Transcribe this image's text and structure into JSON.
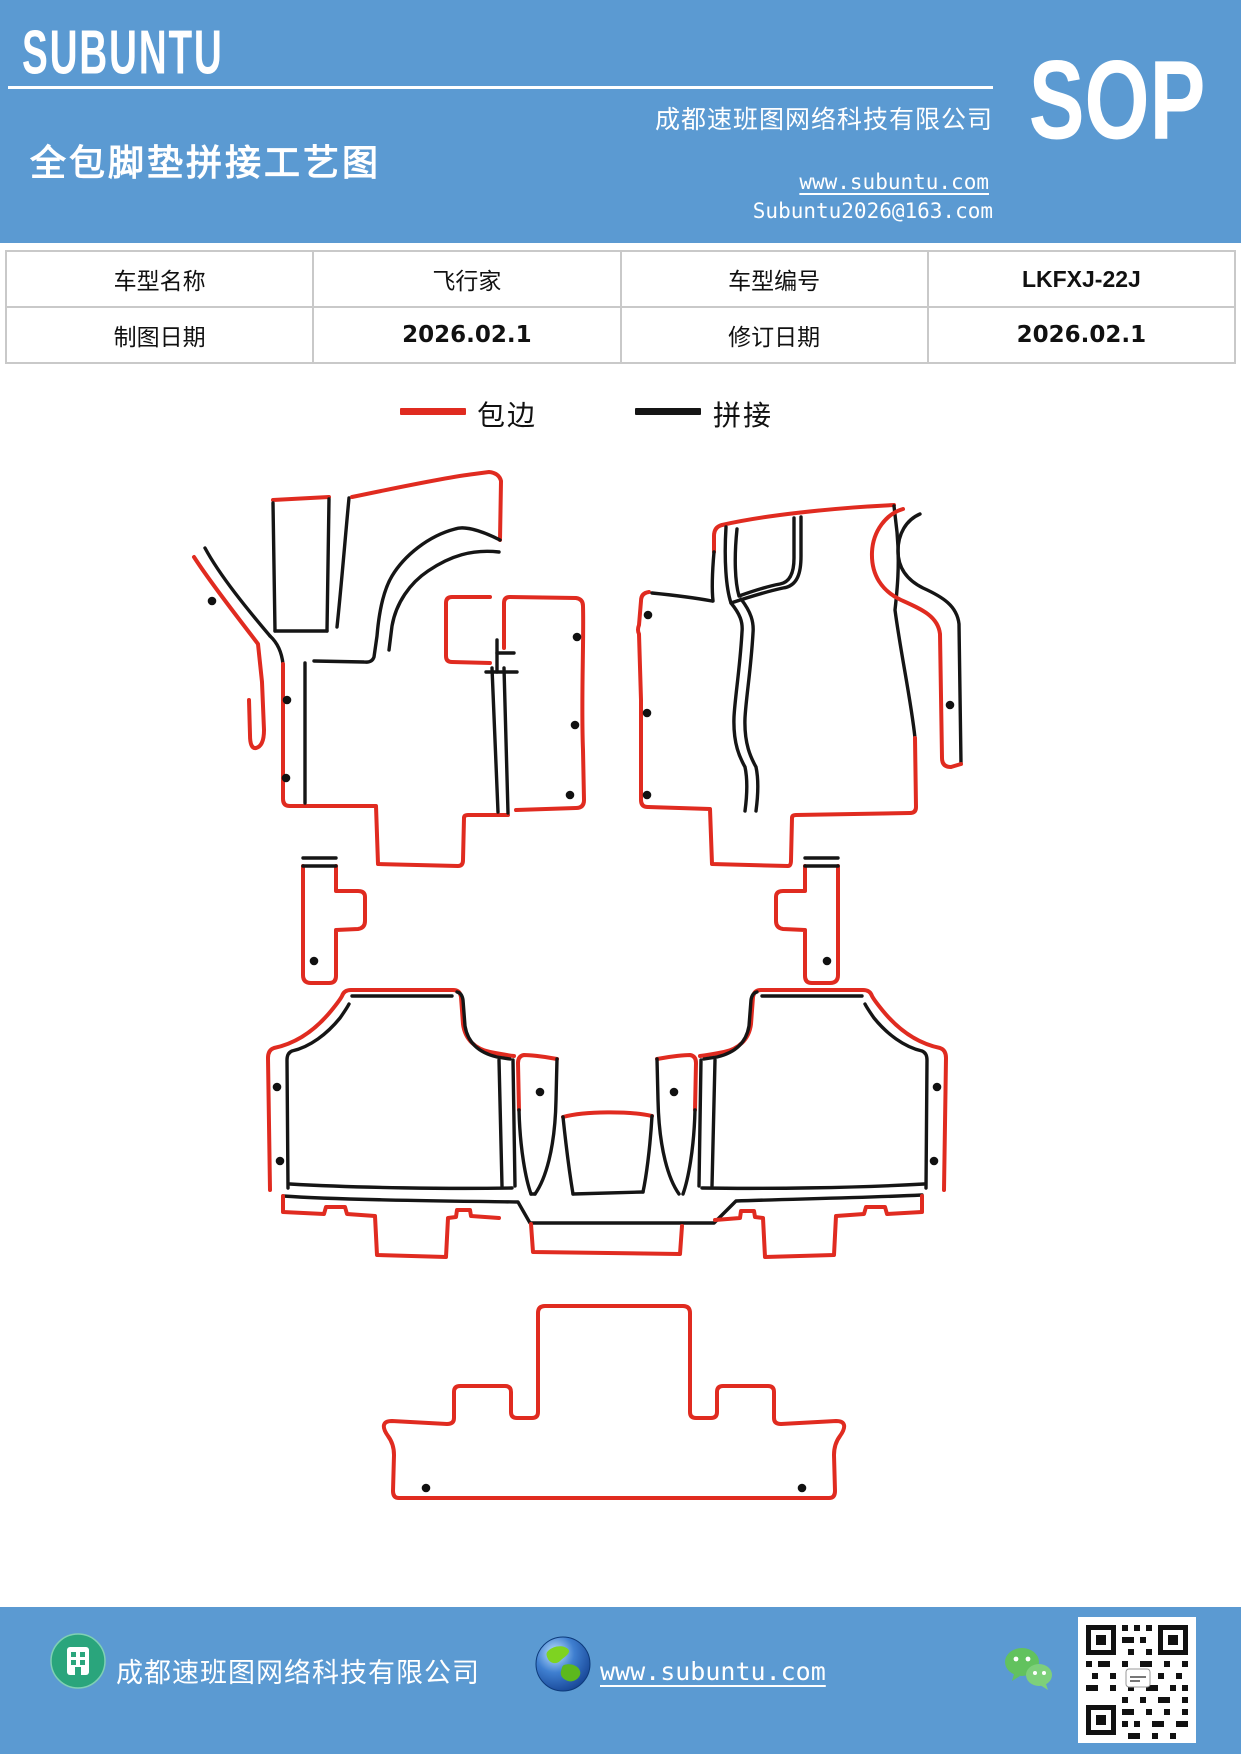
{
  "header": {
    "logo": "SUBUNTU",
    "company": "成都速班图网络科技有限公司",
    "title": "全包脚垫拼接工艺图",
    "website": "www.subuntu.com",
    "email": "Subuntu2026@163.com",
    "badge": "SOP"
  },
  "table": {
    "rows": [
      {
        "label1": "车型名称",
        "value1": "飞行家",
        "label2": "车型编号",
        "value2": "LKFXJ-22J"
      },
      {
        "label1": "制图日期",
        "value1": "2026.02.1",
        "label2": "修订日期",
        "value2": "2026.02.1"
      }
    ]
  },
  "legend": {
    "items": [
      {
        "label": "包边",
        "color": "#e02b20"
      },
      {
        "label": "拼接",
        "color": "#151515"
      }
    ]
  },
  "diagram": {
    "marker": "上",
    "description": "全包脚垫拼接工艺图 - 前排左右脚垫、中排脚垫、后排脚垫裁片轮廓",
    "edge_color": "#e02b20",
    "splice_color": "#151515"
  },
  "footer": {
    "company": "成都速班图网络科技有限公司",
    "website": "www.subuntu.com"
  },
  "colors": {
    "banner_blue": "#5b9ad2",
    "table_border": "#c9c9c9"
  }
}
